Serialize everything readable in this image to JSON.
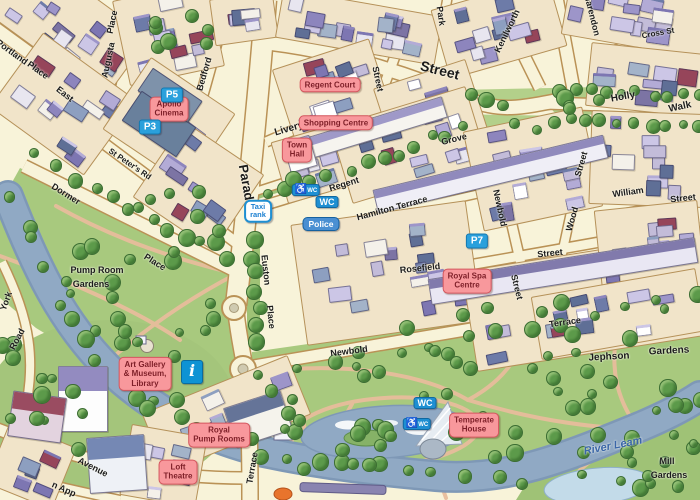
{
  "map_title": "Royal Leamington Spa town centre illustrated map",
  "colors": {
    "background": "#F8F3D9",
    "park_green": "#A8C97E",
    "park_light": "#B3D08A",
    "water": "#90A9C4",
    "water_edge": "#7E98B6",
    "pond_light": "#C3DBE9",
    "road_casing": "#BA9256",
    "block_fill": "#F1E4C9",
    "block_border": "#B59159",
    "landmark_label_bg": "#F8989C",
    "landmark_label_border": "#D4565E",
    "landmark_label_text": "#7E1F28",
    "parking_badge_blue": "#2AA0DC",
    "wc_badge_blue": "#1E8FD2",
    "police_badge_blue": "#4A8FD2",
    "info_badge_blue": "#0E93D4",
    "path_pink": "#E8BD9C",
    "river_label_blue": "#3A66A8"
  },
  "street_labels": [
    {
      "text": "Portland",
      "x": 12,
      "y": 52,
      "rot": 36,
      "size": 9
    },
    {
      "text": "Place",
      "x": 38,
      "y": 70,
      "rot": 36,
      "size": 9
    },
    {
      "text": "East",
      "x": 65,
      "y": 94,
      "rot": 38,
      "size": 9
    },
    {
      "text": "Place",
      "x": 112,
      "y": 22,
      "rot": -78,
      "size": 9
    },
    {
      "text": "Augusta",
      "x": 108,
      "y": 60,
      "rot": -78,
      "size": 9
    },
    {
      "text": "Bedford",
      "x": 204,
      "y": 74,
      "rot": -74,
      "size": 9
    },
    {
      "text": "St Peter's Rd",
      "x": 130,
      "y": 164,
      "rot": 34,
      "size": 8
    },
    {
      "text": "Dormer",
      "x": 66,
      "y": 194,
      "rot": 32,
      "size": 9
    },
    {
      "text": "Place",
      "x": 155,
      "y": 262,
      "rot": 32,
      "size": 9
    },
    {
      "text": "Parade",
      "x": 247,
      "y": 186,
      "rot": 80,
      "size": 13
    },
    {
      "text": "Street",
      "x": 440,
      "y": 70,
      "rot": 14,
      "size": 14
    },
    {
      "text": "Park",
      "x": 441,
      "y": 16,
      "rot": 82,
      "size": 9
    },
    {
      "text": "Street",
      "x": 378,
      "y": 79,
      "rot": 78,
      "size": 9
    },
    {
      "text": "Livery",
      "x": 289,
      "y": 129,
      "rot": -16,
      "size": 10
    },
    {
      "text": "Regent",
      "x": 344,
      "y": 184,
      "rot": -17,
      "size": 9
    },
    {
      "text": "Grove",
      "x": 454,
      "y": 139,
      "rot": -14,
      "size": 9
    },
    {
      "text": "Hamilton Terrace",
      "x": 392,
      "y": 208,
      "rot": -15,
      "size": 9
    },
    {
      "text": "Kenilworth",
      "x": 507,
      "y": 31,
      "rot": -64,
      "size": 9
    },
    {
      "text": "Clarendon",
      "x": 592,
      "y": 14,
      "rot": 76,
      "size": 9
    },
    {
      "text": "Cross St",
      "x": 658,
      "y": 33,
      "rot": -10,
      "size": 8
    },
    {
      "text": "Holly",
      "x": 623,
      "y": 97,
      "rot": -10,
      "size": 10
    },
    {
      "text": "Walk",
      "x": 680,
      "y": 107,
      "rot": -12,
      "size": 10
    },
    {
      "text": "Street",
      "x": 581,
      "y": 164,
      "rot": -74,
      "size": 9
    },
    {
      "text": "Wood",
      "x": 572,
      "y": 219,
      "rot": -74,
      "size": 9
    },
    {
      "text": "William",
      "x": 628,
      "y": 192,
      "rot": -8,
      "size": 9
    },
    {
      "text": "Street",
      "x": 683,
      "y": 198,
      "rot": -6,
      "size": 9
    },
    {
      "text": "Newbold",
      "x": 500,
      "y": 208,
      "rot": 78,
      "size": 9
    },
    {
      "text": "Street",
      "x": 517,
      "y": 287,
      "rot": 76,
      "size": 9
    },
    {
      "text": "Rosefield",
      "x": 420,
      "y": 268,
      "rot": -6,
      "size": 9
    },
    {
      "text": "Street",
      "x": 550,
      "y": 253,
      "rot": -6,
      "size": 9
    },
    {
      "text": "Euston",
      "x": 266,
      "y": 270,
      "rot": 84,
      "size": 9
    },
    {
      "text": "Place",
      "x": 271,
      "y": 317,
      "rot": 84,
      "size": 9
    },
    {
      "text": "Newbold",
      "x": 349,
      "y": 351,
      "rot": -7,
      "size": 9
    },
    {
      "text": "Terrace",
      "x": 565,
      "y": 322,
      "rot": -8,
      "size": 9
    },
    {
      "text": "Terrace",
      "x": 252,
      "y": 468,
      "rot": -80,
      "size": 9
    },
    {
      "text": "Avenue",
      "x": 93,
      "y": 467,
      "rot": 27,
      "size": 9
    },
    {
      "text": "n App",
      "x": 64,
      "y": 489,
      "rot": 24,
      "size": 9
    },
    {
      "text": "York",
      "x": 6,
      "y": 301,
      "rot": -70,
      "size": 9
    },
    {
      "text": "Road",
      "x": 17,
      "y": 339,
      "rot": -62,
      "size": 9
    }
  ],
  "park_labels": [
    {
      "text": "Pump Room",
      "x": 97,
      "y": 270,
      "rot": 0,
      "size": 9
    },
    {
      "text": "Gardens",
      "x": 91,
      "y": 284,
      "rot": 0,
      "size": 9
    },
    {
      "text": "Jephson",
      "x": 609,
      "y": 357,
      "rot": -3,
      "size": 10
    },
    {
      "text": "Gardens",
      "x": 669,
      "y": 351,
      "rot": -3,
      "size": 10
    },
    {
      "text": "Mill",
      "x": 667,
      "y": 461,
      "rot": 0,
      "size": 9
    },
    {
      "text": "Gardens",
      "x": 669,
      "y": 475,
      "rot": 0,
      "size": 9
    }
  ],
  "water_labels": [
    {
      "text": "River Leam",
      "x": 613,
      "y": 446,
      "rot": -11,
      "size": 11
    }
  ],
  "place_labels": [
    {
      "id": "apollo-cinema",
      "lines": [
        "Apollo",
        "Cinema"
      ],
      "x": 169,
      "y": 109
    },
    {
      "id": "regent-court",
      "lines": [
        "Regent Court"
      ],
      "x": 330,
      "y": 85
    },
    {
      "id": "shopping-centre",
      "lines": [
        "Shopping Centre"
      ],
      "x": 336,
      "y": 123
    },
    {
      "id": "town-hall",
      "lines": [
        "Town",
        "Hall"
      ],
      "x": 297,
      "y": 150
    },
    {
      "id": "royal-spa-centre",
      "lines": [
        "Royal Spa",
        "Centre"
      ],
      "x": 467,
      "y": 281
    },
    {
      "id": "art-gallery-museum-library",
      "lines": [
        "Art Gallery",
        "& Museum,",
        "Library"
      ],
      "x": 145,
      "y": 374
    },
    {
      "id": "royal-pump-rooms",
      "lines": [
        "Royal",
        "Pump Rooms"
      ],
      "x": 219,
      "y": 435
    },
    {
      "id": "loft-theatre",
      "lines": [
        "Loft",
        "Theatre"
      ],
      "x": 178,
      "y": 472
    },
    {
      "id": "temperate-house",
      "lines": [
        "Temperate",
        "House"
      ],
      "x": 474,
      "y": 425
    }
  ],
  "badges": [
    {
      "type": "parking",
      "text": "P5",
      "x": 172,
      "y": 95
    },
    {
      "type": "parking",
      "text": "P3",
      "x": 150,
      "y": 127
    },
    {
      "type": "parking",
      "text": "P7",
      "x": 477,
      "y": 241
    },
    {
      "type": "taxi",
      "lines": [
        "Taxi",
        "rank"
      ],
      "x": 258,
      "y": 211
    },
    {
      "type": "wc_access",
      "text": "WC",
      "icon": "wheelchair",
      "x": 306,
      "y": 190
    },
    {
      "type": "wc",
      "text": "WC",
      "x": 327,
      "y": 202
    },
    {
      "type": "police",
      "text": "Police",
      "x": 321,
      "y": 224
    },
    {
      "type": "info",
      "text": "i",
      "icon": "information",
      "x": 192,
      "y": 372
    },
    {
      "type": "wc",
      "text": "WC",
      "x": 425,
      "y": 403
    },
    {
      "type": "wc_access",
      "text": "WC",
      "icon": "wheelchair",
      "x": 417,
      "y": 424
    }
  ]
}
